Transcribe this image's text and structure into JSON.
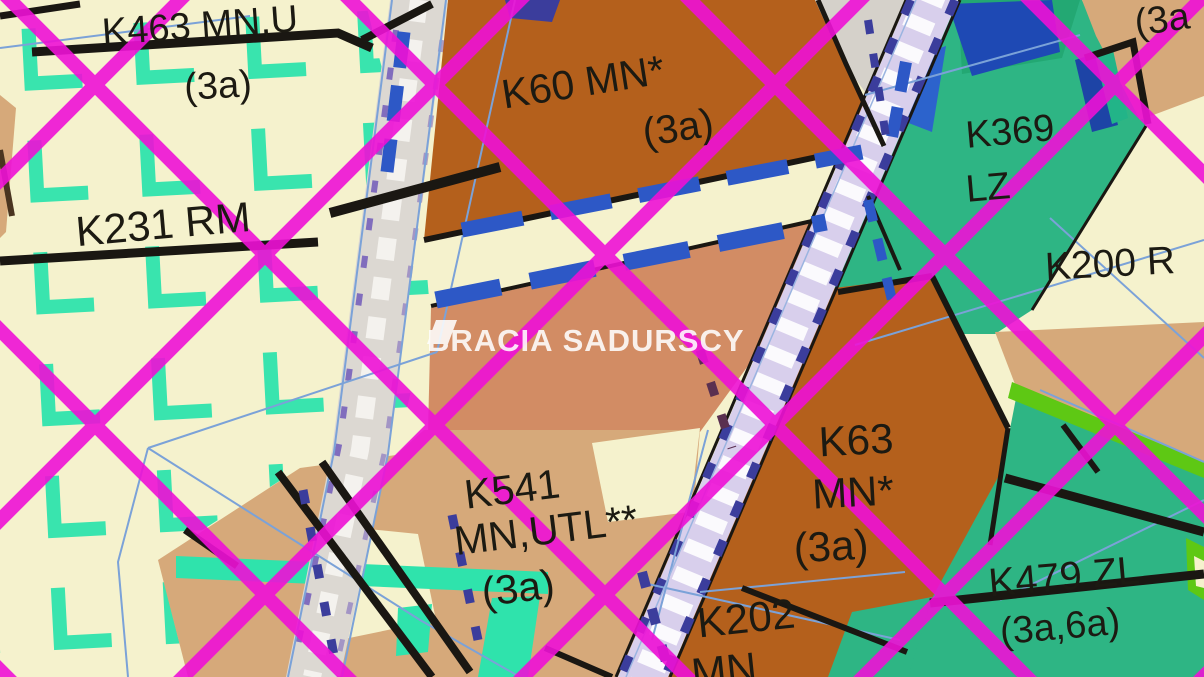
{
  "map": {
    "type": "zoning-plan-map",
    "watermark": {
      "left": "BRACIA",
      "right": "SADURSCY"
    },
    "zones": {
      "k463": {
        "label": "K463 MN,U",
        "suffix": "(3a)"
      },
      "k231": {
        "label": "K231 RM"
      },
      "k60": {
        "label": "K60 MN*",
        "suffix": "(3a)"
      },
      "k369": {
        "label": "K369",
        "label2": "LZ"
      },
      "k200": {
        "label": "K200 R"
      },
      "k541": {
        "label": "K541",
        "label2": "MN,UTL**",
        "suffix": "(3a)"
      },
      "k63": {
        "label": "K63",
        "label2": "MN*",
        "suffix": "(3a)"
      },
      "k479": {
        "label": "K479 ZL",
        "suffix": "(3a,6a)"
      },
      "k202": {
        "label": "K202",
        "label2": "MN"
      },
      "corner_partial": {
        "suffix": "(3a"
      }
    },
    "colors": {
      "background": "#f5f2cd",
      "zone_orange": "#b4601c",
      "zone_salmon": "#d28c64",
      "zone_tan": "#d6a97a",
      "zone_green": "#2eb584",
      "zone_green_dark": "#23a873",
      "zone_lime": "#5ec814",
      "zone_gray": "#d5d1ca",
      "rail_lilac": "#d8cfec",
      "road_gray": "#dcd8d2",
      "teal_grid": "#2fe3ac",
      "crosshatch_magenta": "#ee10d6",
      "dash_royal_blue": "#2d58c6",
      "dash_navy": "#3b3d9c",
      "parcel_blue": "#7ba2d8",
      "boundary_black": "#1a1712",
      "label_color": "#1c1a12",
      "watermark_white": "#ffffff"
    }
  }
}
